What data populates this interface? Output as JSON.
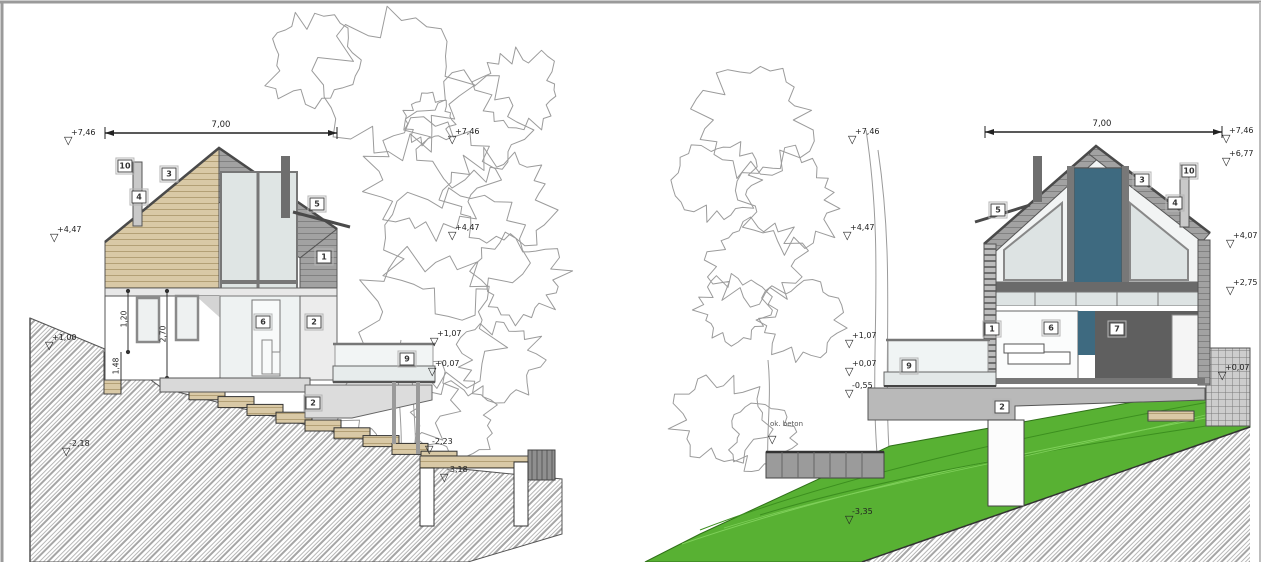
{
  "document": {
    "type": "architectural-cross-sections",
    "description": "Two cross-section / elevation views of a hillside house"
  },
  "colors": {
    "outline": "#4a4a4a",
    "wood_tan": "#d9c9a6",
    "roof_gray": "#a2a2a2",
    "glass_light": "#dfe5e4",
    "glass_blue": "#3e6a80",
    "interior_dark": "#5f5f5f",
    "slab_gray": "#bcbcbc",
    "terrain_hatch": "#ababab",
    "grass_green": "#58b133",
    "tree_line": "#9b9b9b"
  },
  "views": [
    {
      "id": "left-section",
      "dimension_labels": [
        {
          "value": "7,00",
          "x": 221,
          "y": 130
        }
      ],
      "elevation_markers": [
        {
          "value": "+7,46",
          "x": 64,
          "y": 129
        },
        {
          "value": "+4,47",
          "x": 50,
          "y": 226
        },
        {
          "value": "+1,00",
          "x": 45,
          "y": 334
        },
        {
          "value": "-2,18",
          "x": 62,
          "y": 440
        },
        {
          "value": "+7,46",
          "x": 448,
          "y": 128
        },
        {
          "value": "+4,47",
          "x": 448,
          "y": 224
        },
        {
          "value": "+1,07",
          "x": 430,
          "y": 330
        },
        {
          "value": "+0,07",
          "x": 428,
          "y": 360
        },
        {
          "value": "-2,23",
          "x": 425,
          "y": 438
        },
        {
          "value": "-3,18",
          "x": 440,
          "y": 466
        }
      ],
      "callouts": [
        {
          "label": "10",
          "x": 125,
          "y": 166
        },
        {
          "label": "4",
          "x": 139,
          "y": 197
        },
        {
          "label": "3",
          "x": 169,
          "y": 174
        },
        {
          "label": "5",
          "x": 317,
          "y": 204
        },
        {
          "label": "1",
          "x": 324,
          "y": 257
        },
        {
          "label": "6",
          "x": 263,
          "y": 322
        },
        {
          "label": "2",
          "x": 314,
          "y": 322
        },
        {
          "label": "9",
          "x": 407,
          "y": 359
        },
        {
          "label": "2",
          "x": 313,
          "y": 403
        }
      ],
      "vertical_dimensions": [
        {
          "value": "1,20",
          "x": 124,
          "y": 319
        },
        {
          "value": "2,70",
          "x": 163,
          "y": 334
        },
        {
          "value": "1,48",
          "x": 116,
          "y": 366
        }
      ],
      "annotations": []
    },
    {
      "id": "right-section",
      "dimension_labels": [
        {
          "value": "7,00",
          "x": 1102,
          "y": 129
        }
      ],
      "elevation_markers": [
        {
          "value": "+7,46",
          "x": 848,
          "y": 128
        },
        {
          "value": "+4,47",
          "x": 843,
          "y": 224
        },
        {
          "value": "+1,07",
          "x": 845,
          "y": 332
        },
        {
          "value": "+0,07",
          "x": 845,
          "y": 360
        },
        {
          "value": "-0,55",
          "x": 845,
          "y": 382
        },
        {
          "value": "",
          "x": 768,
          "y": 436
        },
        {
          "value": "-3,35",
          "x": 845,
          "y": 508
        },
        {
          "value": "+7,46",
          "x": 1222,
          "y": 127
        },
        {
          "value": "+6,77",
          "x": 1222,
          "y": 150
        },
        {
          "value": "+4,07",
          "x": 1226,
          "y": 232
        },
        {
          "value": "+2,75",
          "x": 1226,
          "y": 279
        },
        {
          "value": "+0,07",
          "x": 1218,
          "y": 364
        }
      ],
      "callouts": [
        {
          "label": "5",
          "x": 998,
          "y": 210
        },
        {
          "label": "3",
          "x": 1142,
          "y": 180
        },
        {
          "label": "10",
          "x": 1189,
          "y": 171
        },
        {
          "label": "4",
          "x": 1175,
          "y": 203
        },
        {
          "label": "1",
          "x": 992,
          "y": 329
        },
        {
          "label": "6",
          "x": 1051,
          "y": 328
        },
        {
          "label": "7",
          "x": 1117,
          "y": 329
        },
        {
          "label": "9",
          "x": 909,
          "y": 366
        },
        {
          "label": "2",
          "x": 1002,
          "y": 407
        }
      ],
      "vertical_dimensions": [],
      "annotations": [
        {
          "value": "ok. beton",
          "x": 770,
          "y": 420
        }
      ]
    }
  ]
}
